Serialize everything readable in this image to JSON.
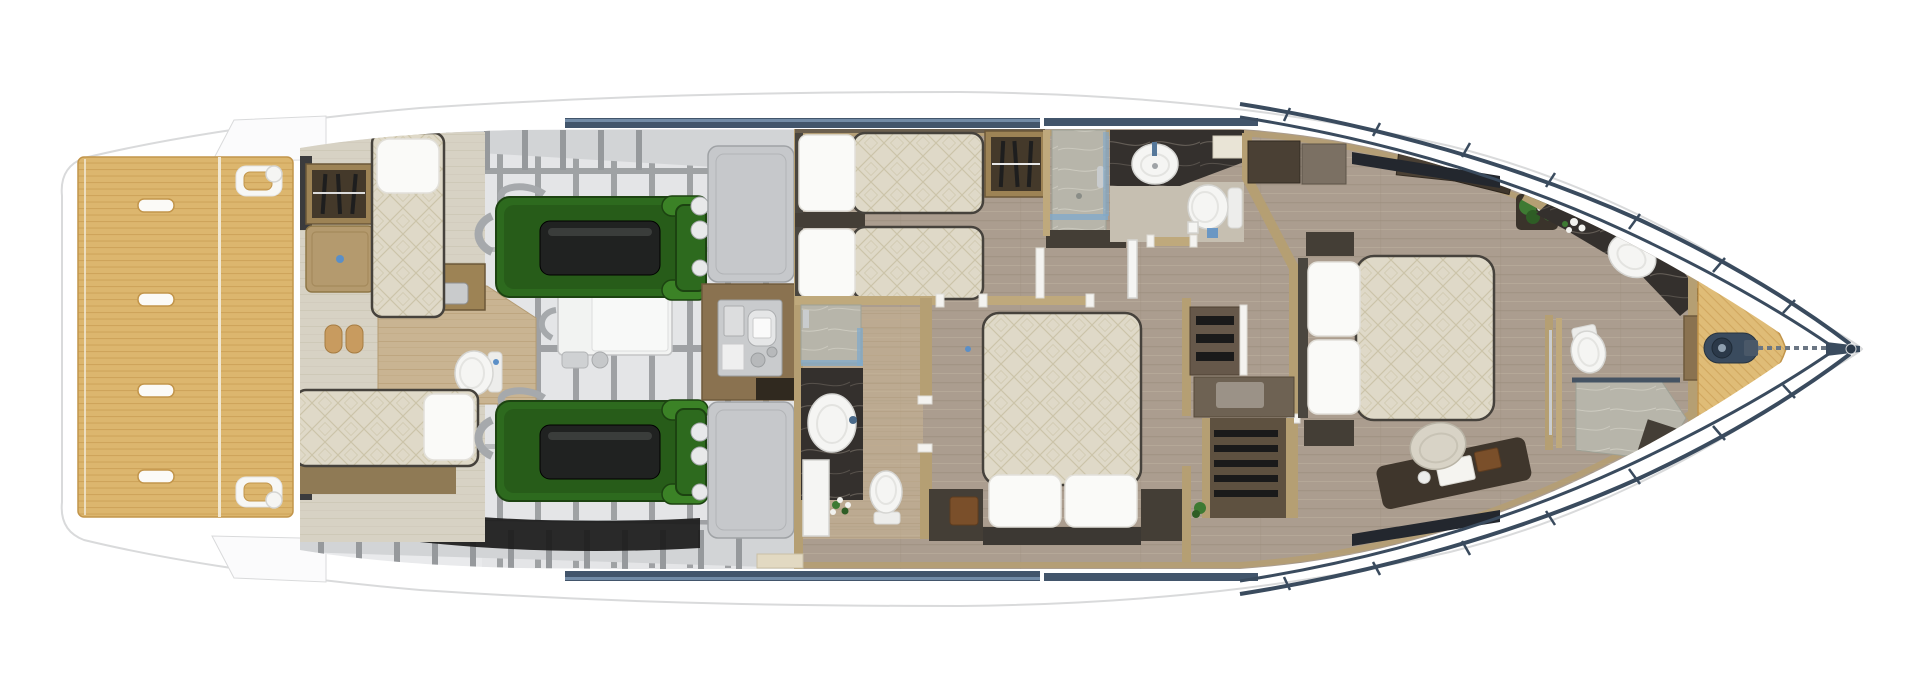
{
  "vessel": {
    "view": "yacht-lower-deck-floor-plan",
    "regions": [
      "swim-platform",
      "crew-quarters",
      "crew-bathroom",
      "engine-room",
      "technical-room",
      "twin-guest-cabin",
      "guest-shower",
      "guest-bathroom",
      "vip-bathroom",
      "vip-cabin",
      "companionway-stairs",
      "master-cabin",
      "master-bathroom",
      "bow-deck"
    ]
  },
  "counts": {
    "swim_platform_handles": 4,
    "engines": 2,
    "generator": 1,
    "beds": 6,
    "toilets": 4,
    "sinks": 4,
    "wardrobes": 2,
    "hangers_per_wardrobe": 3,
    "stools": 2,
    "stair_flights": 2
  },
  "colors": {
    "hull_white": "#FFFFFF",
    "hull_outline": "#D9DADB",
    "teak": "#DCB66E",
    "teak_line": "#C2954B",
    "bow_teak": "#DFBC77",
    "rail_navy": "#3A4B5E",
    "window_navy": "#42556B",
    "window_highlight": "#7E99B5",
    "bilge": "#E9EAEC",
    "band_gray": "#D2D4D6",
    "rib_gray": "#96999C",
    "frame_gray": "#8E9194",
    "black": "#1A1A1A",
    "engine_floor": "#E4E5E7",
    "engine_green": "#2D6A1E",
    "engine_green_dark": "#1C4311",
    "engine_green_light": "#3B8226",
    "engine_black": "#202221",
    "pipe_gray": "#A6A9AC",
    "generator_white": "#F2F3F2",
    "tank_gray": "#C6C8CB",
    "tech_brown": "#8A7250",
    "equip_gray": "#C9CBCD",
    "crew_floor": "#D7D2C4",
    "bath_tan": "#C9B492",
    "bath_streak": "#B89F77",
    "bath2_floor": "#C6BFB1",
    "wood": "#AB9D8F",
    "wood_dark": "#9A8B7C",
    "wood_light": "#BCAF9F",
    "wall_tan": "#BFA97C",
    "bulkhead_tan": "#B59F73",
    "post_white": "#F4F3F0",
    "mattress": "#DFD9C8",
    "mattress_line": "#CCC4A9",
    "mattress_edge": "#46423C",
    "pillow": "#FAFAF8",
    "pillow_edge": "#E2E0DA",
    "bedbase_brown": "#8F7A55",
    "furn_dark": "#443E36",
    "wardrobe_brown": "#9D8355",
    "wardrobe_inner": "#44392A",
    "hanger_black": "#1E1E1E",
    "marble_dark": "#34302D",
    "marble_vein": "#6E675F",
    "marble_light": "#B7B5AA",
    "white_fixture": "#F5F5F3",
    "fixture_edge": "#D5D5D2",
    "glass_blue": "#7FA9CC",
    "accent_blue": "#5B8FC7",
    "chrome": "#C9CCCE",
    "plant_green": "#3E7A33",
    "plant_dark": "#2E5D25",
    "desk_dark": "#3F362C",
    "chair_beige": "#D8D3C6",
    "stool_wood": "#C89B5F",
    "stair_brown": "#66584A",
    "box_brown": "#7A4F2A",
    "cream_cab": "#E9E4D6",
    "step_white": "#FBFBFC",
    "dark_corner": "#3B3B3D",
    "wedge_dark": "#23272E",
    "headboard": "#4A463F"
  }
}
